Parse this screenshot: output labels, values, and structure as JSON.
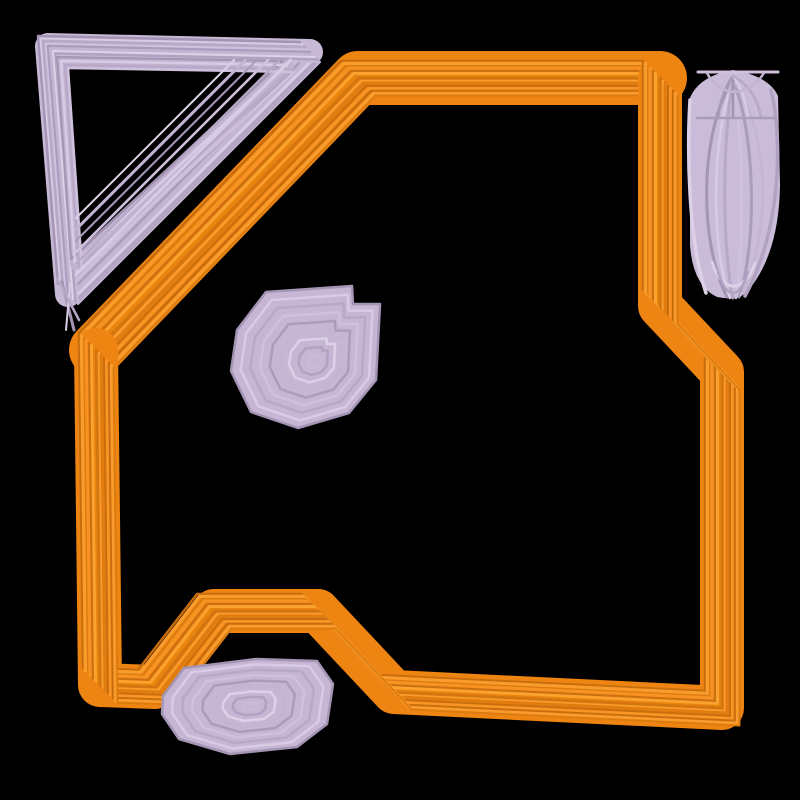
{
  "canvas": {
    "width": 800,
    "height": 800,
    "background": "#000000"
  },
  "palettes": {
    "orange_base": "#ee8411",
    "orange": [
      "#c76d0d",
      "#fa9c2b",
      "#dc7c10",
      "#f79322",
      "#cc7010",
      "#fba32f",
      "#e8850f",
      "#d47610",
      "#fb9d2d",
      "#e07c10",
      "#c96e0d",
      "#f89526"
    ],
    "purple_base": "#c7b8d5",
    "purple": [
      "#a495b5",
      "#d8cce4",
      "#b6a8c6",
      "#cfc1dd",
      "#aa9cbc",
      "#c3b4d2",
      "#dcd1e7",
      "#b0a2c0",
      "#c9bbd8",
      "#a79ab7"
    ]
  },
  "shapes": [
    {
      "name": "fold-triangle-outline",
      "type": "band",
      "points": [
        [
          48,
          46
        ],
        [
          310,
          52
        ],
        [
          68,
          294
        ]
      ],
      "closed": true,
      "width": 26,
      "color": "#c7b8d5",
      "stripes": {
        "palette": "purple",
        "offsets": [
          -10,
          -7.5,
          -5,
          -2.5,
          0,
          2.5,
          5,
          7.5,
          10
        ],
        "widths": [
          2.5,
          2,
          3,
          2,
          2.5,
          3,
          2,
          2.5,
          2
        ]
      }
    },
    {
      "name": "fold-triangle-inner-ring",
      "type": "band",
      "points": [
        [
          62,
          62
        ],
        [
          288,
          66
        ],
        [
          76,
          264
        ]
      ],
      "closed": true,
      "width": 12,
      "color": "#c2b2d1",
      "stripes": {
        "palette": "purple",
        "offsets": [
          -5,
          -1,
          3,
          6
        ],
        "widths": [
          2,
          2.5,
          2,
          2.5
        ]
      }
    },
    {
      "name": "fold-triangle-hypotenuse-hatch",
      "type": "hatch",
      "p1": [
        302,
        60
      ],
      "p2": [
        76,
        286
      ],
      "count": 6,
      "spacing": 8,
      "widths": [
        3,
        2,
        2.5,
        2,
        3,
        2
      ],
      "palette": "purple"
    },
    {
      "name": "fold-triangle-tail-strokes",
      "type": "lines",
      "segments": [
        [
          62,
          282,
          74,
          330
        ],
        [
          70,
          284,
          66,
          330
        ],
        [
          57,
          278,
          79,
          320
        ]
      ],
      "widths": [
        3,
        2,
        2.5
      ],
      "palette": "purple"
    },
    {
      "name": "document-outline-top-and-fold-edge",
      "type": "band",
      "points": [
        [
          96,
          350
        ],
        [
          358,
          78
        ],
        [
          660,
          78
        ]
      ],
      "closed": false,
      "width": 54,
      "color": "#ee8411",
      "stripes": {
        "palette": "orange",
        "offsets": [
          -17,
          -14.5,
          -12,
          -9.5,
          -7,
          -4.5,
          -2,
          0.5,
          3,
          5.5,
          8,
          10.5,
          13,
          15.5,
          17.5
        ],
        "widths": [
          2.5,
          3.5,
          2,
          4,
          2.5,
          3,
          2,
          3.5,
          2.5,
          4,
          2,
          3,
          2.5,
          3.5,
          2
        ]
      }
    },
    {
      "name": "document-outline-right-bottom-left",
      "type": "band",
      "points": [
        [
          660,
          78
        ],
        [
          660,
          306
        ],
        [
          722,
          372
        ],
        [
          722,
          708
        ],
        [
          394,
          692
        ],
        [
          318,
          611
        ],
        [
          214,
          611
        ],
        [
          155,
          687
        ],
        [
          100,
          685
        ],
        [
          96,
          350
        ]
      ],
      "closed": false,
      "width": 44,
      "color": "#ee8411",
      "stripes": {
        "palette": "orange",
        "offsets": [
          -17,
          -14.5,
          -12,
          -9.5,
          -7,
          -4.5,
          -2,
          0.5,
          3,
          5.5,
          8,
          10.5,
          13,
          15.5,
          17.5
        ],
        "widths": [
          2.5,
          3.5,
          2,
          4,
          2.5,
          3,
          2,
          3.5,
          2.5,
          4,
          2,
          3,
          2.5,
          3.5,
          2
        ]
      }
    },
    {
      "name": "shuttlecock-pill",
      "type": "filled",
      "fill": "#cabcd8",
      "d": "M 690 98 Q 699 76 733 70 Q 769 76 778 96 L 780 185 Q 779 255 747 292 Q 737 301 717 297 Q 693 286 690 245 Z",
      "strokes": [
        {
          "d": "M 733 80 C 700 130 698 240 727 297",
          "w": 3
        },
        {
          "d": "M 733 80 C 712 135 710 245 730 298",
          "w": 2.5
        },
        {
          "d": "M 733 80 C 722 140 722 250 733 298",
          "w": 3
        },
        {
          "d": "M 733 80 C 744 140 744 250 736 298",
          "w": 2.5
        },
        {
          "d": "M 733 80 C 756 135 757 245 739 297",
          "w": 3
        },
        {
          "d": "M 733 80 C 770 130 772 235 741 295",
          "w": 2.5
        },
        {
          "d": "M 690 100 C 687 150 688 240 706 293",
          "w": 3.5
        },
        {
          "d": "M 771 90 C 783 140 781 230 745 296",
          "w": 3.5
        },
        {
          "d": "M 733 76 Q 710 88 705 118",
          "w": 2.5
        },
        {
          "d": "M 733 76 Q 721 92 718 118",
          "w": 2.5
        },
        {
          "d": "M 733 76 Q 733 96 733 118",
          "w": 2.5
        },
        {
          "d": "M 733 76 Q 745 92 748 118",
          "w": 2.5
        },
        {
          "d": "M 733 76 Q 756 88 761 118",
          "w": 2.5
        },
        {
          "d": "M 698 72 L 778 72",
          "w": 3
        },
        {
          "d": "M 697 118 L 775 118",
          "w": 2.5
        },
        {
          "d": "M 707 73 C 720 98 748 98 764 73",
          "w": 2.5
        },
        {
          "d": "M 712 262 C 722 294 744 294 755 263",
          "w": 3
        },
        {
          "d": "M 718 272 C 727 300 739 300 748 272",
          "w": 2.5
        }
      ],
      "palette": "purple"
    },
    {
      "name": "spiral-pentagon-blob",
      "type": "rings",
      "points": [
        [
          266,
          292
        ],
        [
          352,
          286
        ],
        [
          353,
          304
        ],
        [
          380,
          304
        ],
        [
          376,
          380
        ],
        [
          349,
          413
        ],
        [
          298,
          428
        ],
        [
          251,
          412
        ],
        [
          231,
          371
        ],
        [
          237,
          330
        ]
      ],
      "center": [
        315,
        362
      ],
      "count": 9,
      "min_scale": 0.08,
      "width": 2.5,
      "fill": "#c6b6d4",
      "palette": "purple"
    },
    {
      "name": "bottom-concentric-blob",
      "type": "rings",
      "points": [
        [
          163,
          696
        ],
        [
          184,
          668
        ],
        [
          256,
          659
        ],
        [
          317,
          661
        ],
        [
          333,
          684
        ],
        [
          327,
          724
        ],
        [
          297,
          747
        ],
        [
          230,
          754
        ],
        [
          179,
          739
        ],
        [
          162,
          714
        ]
      ],
      "center": [
        250,
        706
      ],
      "count": 9,
      "min_scale": 0.08,
      "width": 2.5,
      "fill": "#c6b6d4",
      "palette": "purple"
    }
  ]
}
